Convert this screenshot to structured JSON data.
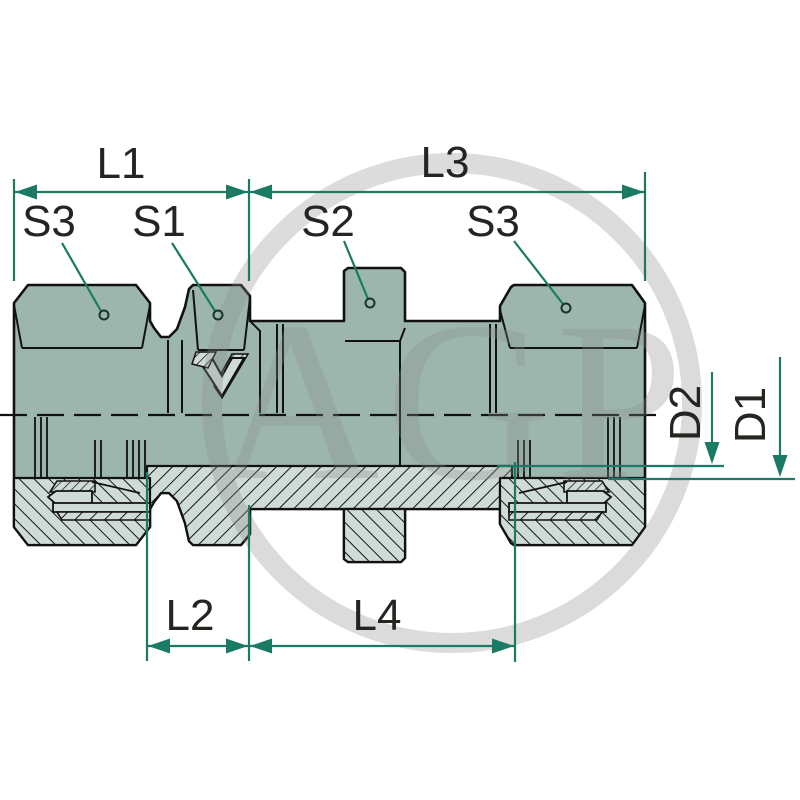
{
  "drawing": {
    "type": "technical-drawing-bulkhead-fitting",
    "watermark": {
      "text": "AGP"
    },
    "labels": {
      "l1": "L1",
      "l3": "L3",
      "s3_left": "S3",
      "s1": "S1",
      "s2": "S2",
      "s3_right": "S3",
      "l2": "L2",
      "l4": "L4",
      "d2": "D2",
      "d1": "D1"
    },
    "colors": {
      "body_fill": "#9cb6ae",
      "section_fill": "#cfdbd5",
      "outline": "#111111",
      "dimension_green": "#1a7a64",
      "label_color": "#262421",
      "watermark_gray": "#8c8c8c",
      "background": "#ffffff"
    }
  }
}
